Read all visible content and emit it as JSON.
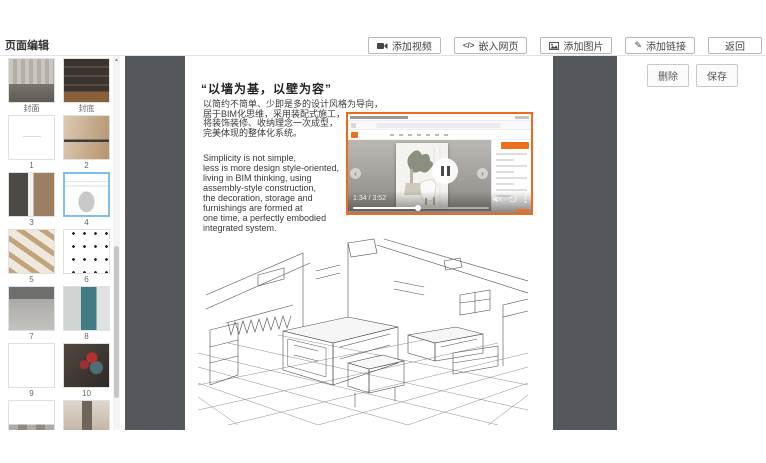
{
  "app": {
    "title": "页面编辑"
  },
  "toolbar": {
    "buttons": [
      {
        "label": "添加视频",
        "icon": "video-camera-icon"
      },
      {
        "label": "嵌入网页",
        "icon": "code-icon"
      },
      {
        "label": "添加图片",
        "icon": "image-icon"
      },
      {
        "label": "添加链接",
        "icon": "link-icon"
      },
      {
        "label": "返回",
        "icon": ""
      }
    ],
    "delete_label": "删除",
    "save_label": "保存"
  },
  "sidebar": {
    "thumbnails": [
      {
        "label": "封面",
        "visual": "photo-cover",
        "selected": false
      },
      {
        "label": "封底",
        "visual": "photo-backcover",
        "selected": false
      },
      {
        "label": "1",
        "visual": "page-text",
        "selected": false
      },
      {
        "label": "2",
        "visual": "photo-wood",
        "selected": false
      },
      {
        "label": "3",
        "visual": "photo-dark-interior",
        "selected": false
      },
      {
        "label": "4",
        "visual": "page-sketch",
        "selected": true
      },
      {
        "label": "5",
        "visual": "photo-beams",
        "selected": false
      },
      {
        "label": "6",
        "visual": "page-dots",
        "selected": false
      },
      {
        "label": "7",
        "visual": "photo-kitchen",
        "selected": false
      },
      {
        "label": "8",
        "visual": "photo-teal",
        "selected": false
      },
      {
        "label": "9",
        "visual": "page-blank",
        "selected": false
      },
      {
        "label": "10",
        "visual": "photo-flowers",
        "selected": false
      },
      {
        "label": "",
        "visual": "page-mixed",
        "selected": false
      },
      {
        "label": "",
        "visual": "photo-beige",
        "selected": false
      }
    ]
  },
  "page": {
    "title": "“以墙为基，以壁为容”",
    "cn_lines": [
      "以简约不简单、少即是多的设计风格为导向，",
      "居于BIM化思维，采用装配式施工，",
      "将装饰装修、收纳理念一次成型，",
      "完美体现的整体化系统。"
    ],
    "en_lines": [
      "Simplicity is not simple,",
      "less is more design style-oriented,",
      "living in BIM thinking,  using",
      "assembly-style construction,",
      "the decoration,  storage and",
      "furnishings are formed at",
      "one time,  a perfectly embodied",
      "integrated system."
    ],
    "video": {
      "time": "1:34 / 3:52",
      "progress_percent": 48,
      "border_color": "#ee6a1f"
    }
  },
  "colors": {
    "accent_orange": "#ee6a1f",
    "selected_thumb_border": "#7ec0ea",
    "canvas_gray": "#54575b"
  }
}
